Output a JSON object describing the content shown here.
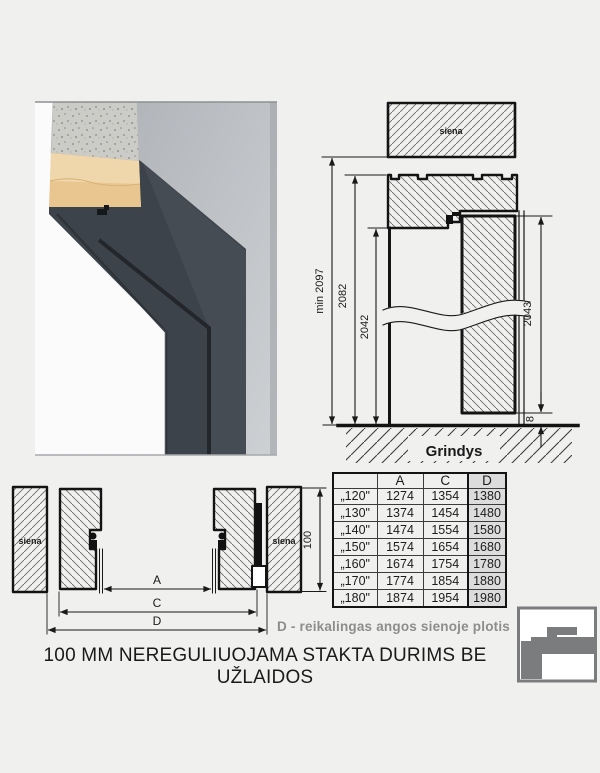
{
  "colors": {
    "background": "#f0f0ee",
    "line": "#1a1a1a",
    "note_text": "#8d8d8d",
    "table_highlight_column": "#dcdcdc",
    "logo_gray": "#7b7c7e",
    "photo_frame": "#3d434a",
    "photo_wall": "#c0c4c8",
    "photo_board": "#e9c68f",
    "photo_concrete": "#cbcbc7"
  },
  "photo": {
    "alt": "door frame corner profile cross-section photo"
  },
  "vertical_section": {
    "wall_label": "siena",
    "floor_label": "Grindys",
    "dim_min_height": "min 2097",
    "dim_frame_height": "2082",
    "dim_opening_height": "2042",
    "dim_door_height": "2043",
    "dim_floor_gap": "8"
  },
  "horizontal_section": {
    "left_wall_label": "siena",
    "right_wall_label": "siena",
    "dim_wall_thickness": "100",
    "dim_a_label": "A",
    "dim_c_label": "C",
    "dim_d_label": "D"
  },
  "size_table": {
    "headers": [
      "",
      "A",
      "C",
      "D"
    ],
    "rows": [
      {
        "size": "„120\"",
        "A": "1274",
        "C": "1354",
        "D": "1380"
      },
      {
        "size": "„130\"",
        "A": "1374",
        "C": "1454",
        "D": "1480"
      },
      {
        "size": "„140\"",
        "A": "1474",
        "C": "1554",
        "D": "1580"
      },
      {
        "size": "„150\"",
        "A": "1574",
        "C": "1654",
        "D": "1680"
      },
      {
        "size": "„160\"",
        "A": "1674",
        "C": "1754",
        "D": "1780"
      },
      {
        "size": "„170\"",
        "A": "1774",
        "C": "1854",
        "D": "1880"
      },
      {
        "size": "„180\"",
        "A": "1874",
        "C": "1954",
        "D": "1980"
      }
    ]
  },
  "note": "D - reikalingas angos sienoje plotis",
  "caption": "100 MM NEREGULIUOJAMA STAKTA DURIMS BE UŽLAIDOS"
}
